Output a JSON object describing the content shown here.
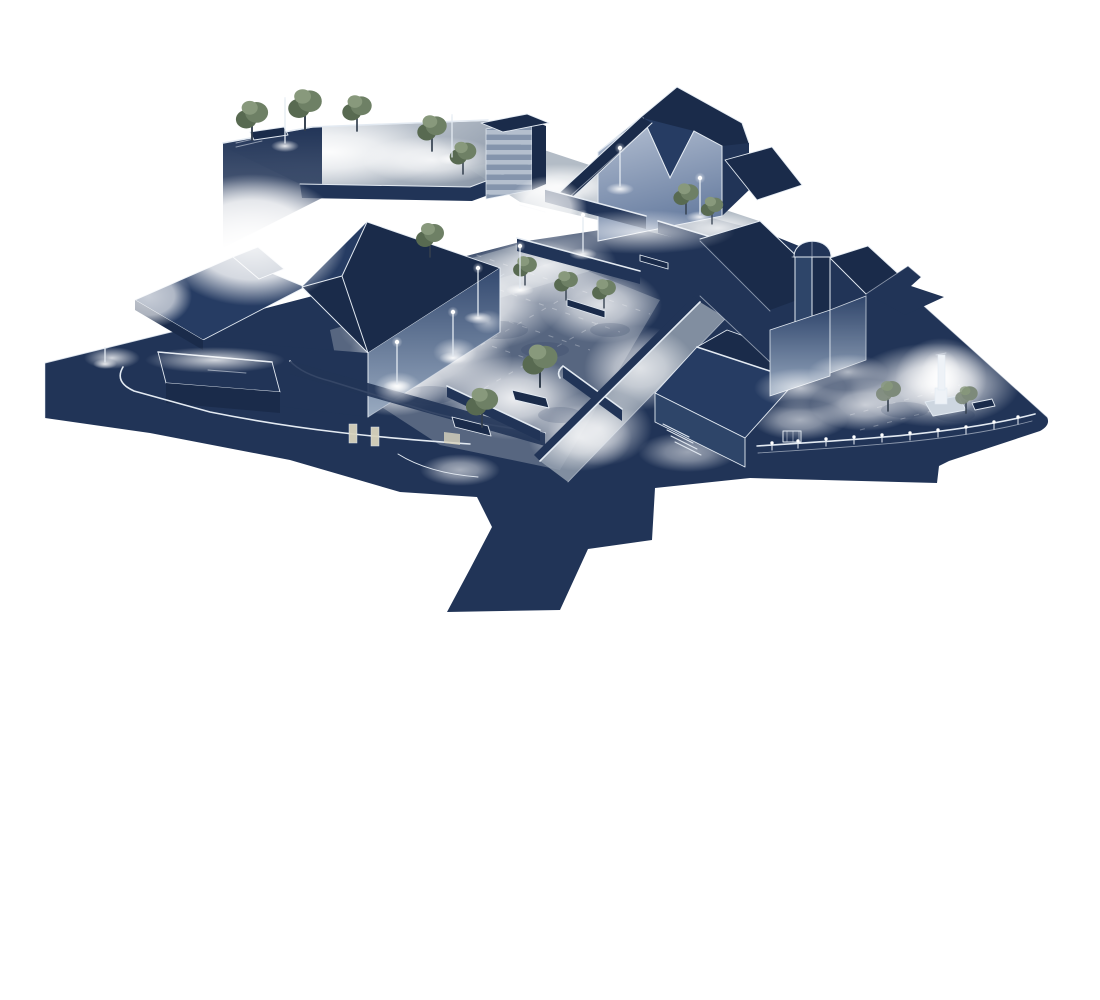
{
  "scene": {
    "type": "Axonometric night-time lighting rendering of a town square",
    "background": "#ffffff",
    "elements": [
      {
        "name": "ground-mass",
        "features": [
          "navy silhouette plinth"
        ]
      },
      {
        "name": "upper-terrace",
        "features": [
          "lit deck",
          "parapet wall",
          "trees",
          "light poles",
          "bench"
        ]
      },
      {
        "name": "stair-tower",
        "features": [
          "striped facade",
          "dark roof cap"
        ]
      },
      {
        "name": "main-hall",
        "features": [
          "valley roof",
          "lit gable wall"
        ]
      },
      {
        "name": "upper-walkway",
        "features": [
          "light pools",
          "low walls",
          "trees"
        ]
      },
      {
        "name": "left-building",
        "features": [
          "hipped roof",
          "flat annex",
          "lit side wall",
          "doorways",
          "perimeter wall"
        ]
      },
      {
        "name": "central-plaza",
        "features": [
          "light pools",
          "trees",
          "planters",
          "benches",
          "low walls",
          "ramp"
        ]
      },
      {
        "name": "gable-house",
        "features": [
          "gabled roof",
          "entry steps"
        ]
      },
      {
        "name": "church",
        "features": [
          "dome tower",
          "nave roof",
          "arrow roof",
          "lit lower walls"
        ]
      },
      {
        "name": "churchyard",
        "features": [
          "glowing monument",
          "trees",
          "curved bollard wall",
          "gate",
          "bench"
        ]
      }
    ],
    "counts": {
      "trees": 15,
      "light_poles": 10,
      "bollards": 10,
      "benches": 4,
      "doorways": 3,
      "step_treads": 4
    }
  },
  "palette": {
    "background": "#ffffff",
    "navy": "#213457",
    "navyDark": "#1a2b4a",
    "roof": "#263c63",
    "roofLight": "#2e4569",
    "wallLitTop": "#33496f",
    "wallLitBottom": "#9aabc1",
    "gableTop": "#b7c2d4",
    "gableBottom": "#647a9e",
    "pave": "#9aa5b3",
    "paveLight": "#d5dae0",
    "stripeLight": "#b4bfce",
    "stripeMid": "#8494ac",
    "terrBright": "#f0f3f6",
    "terrDim": "#8d99a9",
    "outline": "#e3eaf2",
    "glow": "#ffffff",
    "treeMain": "#6e8065",
    "treeLight": "#88997c",
    "treeDark": "#586a51",
    "treeGray": "#7d8a7a",
    "trunk": "#333f4e",
    "door": "#d8d3bd",
    "monument": "#eef2f7",
    "monumentBase": "#cdd6e0"
  }
}
